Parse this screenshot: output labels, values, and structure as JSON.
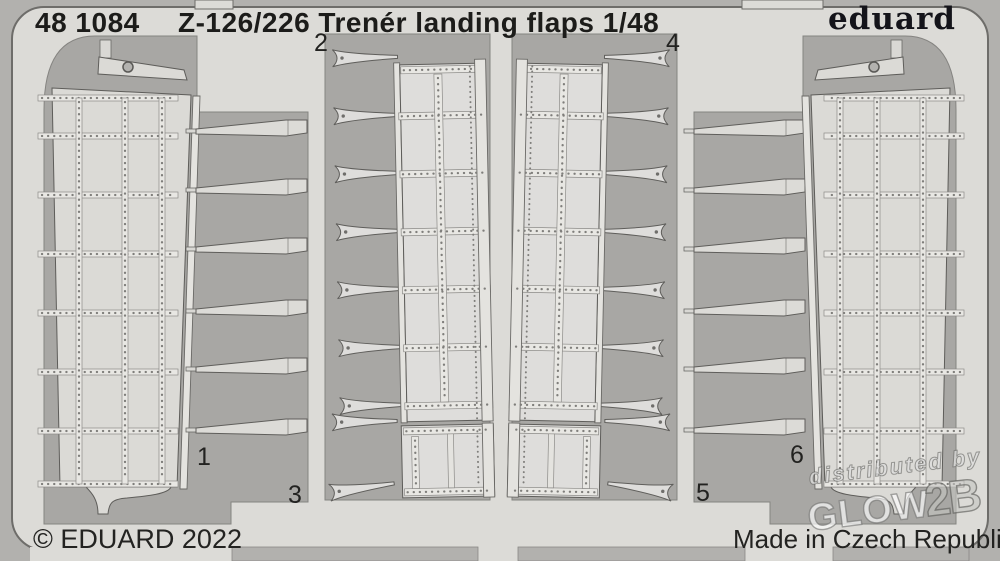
{
  "colors": {
    "margin_background": "#b2b1ae",
    "sheet_metal": "#dcdbd7",
    "etched_window": "#a8a7a4",
    "metal_part": "#dbdad6",
    "rivet_strip": "#e8e7e3",
    "text": "#1c1c1a",
    "watermark": "#ffffff"
  },
  "header": {
    "catalog_number": "48 1084",
    "title": "Z-126/226 Trenér landing flaps 1/48",
    "brand_logo": "eduard"
  },
  "part_labels": [
    "1",
    "2",
    "3",
    "4",
    "5",
    "6"
  ],
  "footer": {
    "copyright": "© EDUARD 2022",
    "made_in": "Made in Czech Republic"
  },
  "watermark": {
    "distributed_by": "distributed by",
    "brand_main": "GLOW",
    "brand_suffix": "2B"
  }
}
